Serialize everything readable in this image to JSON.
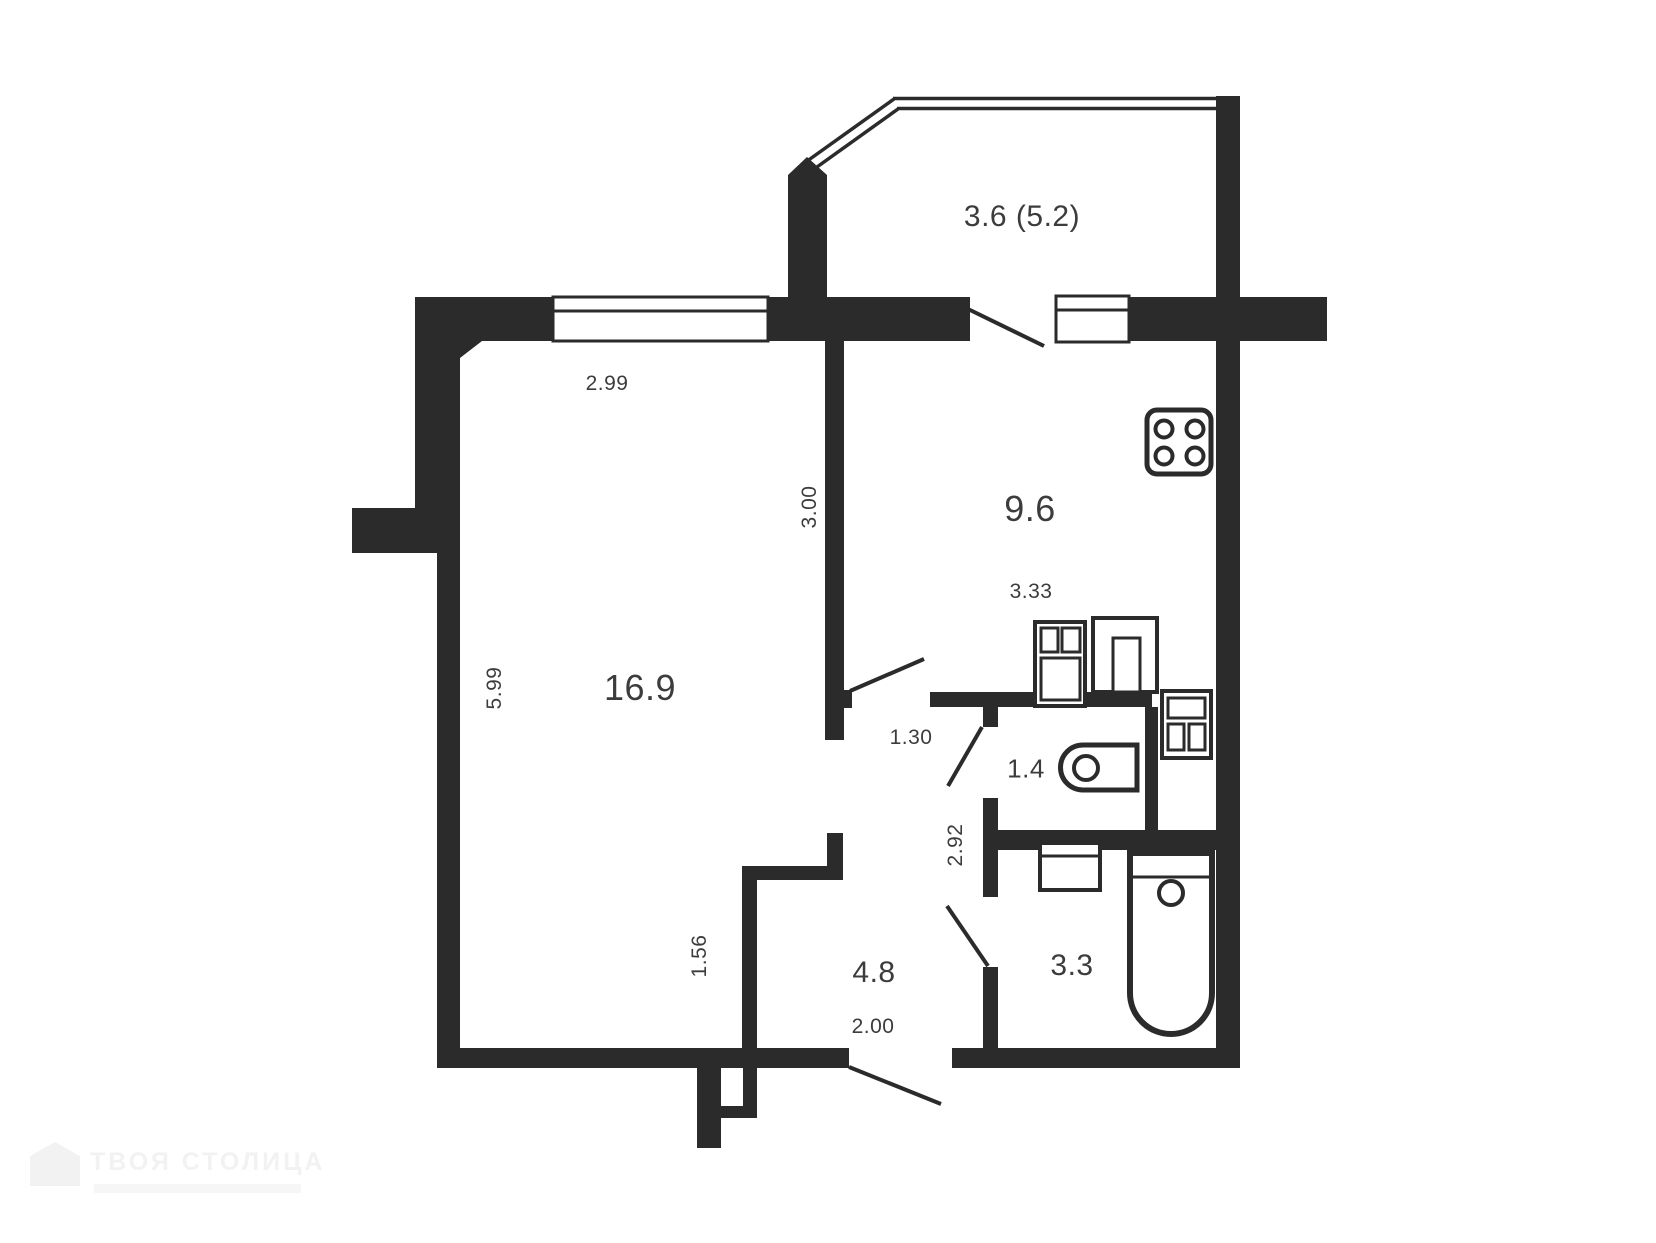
{
  "colors": {
    "wall": "#2b2b2b",
    "text": "#3c3c3c",
    "background": "#ffffff",
    "watermark": "#f2f2f2"
  },
  "rooms": {
    "balcony": {
      "name": "balcony",
      "area": "3.6 (5.2)"
    },
    "kitchen": {
      "name": "kitchen",
      "area": "9.6"
    },
    "living_room": {
      "name": "living-room",
      "area": "16.9"
    },
    "hallway": {
      "name": "hallway",
      "area": "4.8"
    },
    "toilet": {
      "name": "toilet",
      "area": "1.4"
    },
    "bathroom": {
      "name": "bathroom",
      "area": "3.3"
    }
  },
  "dimensions": {
    "living_width": "2.99",
    "kitchen_width": "3.00",
    "kitchen_depth": "3.33",
    "living_height": "5.99",
    "hall_door_width": "1.30",
    "hall_depth": "2.92",
    "living_nook": "1.56",
    "hall_width": "2.00"
  },
  "fixtures": [
    "stove-icon",
    "kitchen-sink-icon",
    "kitchen-cabinet-icon",
    "washer-icon",
    "toilet-icon",
    "bathroom-sink-icon",
    "bathtub-icon"
  ],
  "watermark": {
    "text": "ТВОЯ СТОЛИЦА"
  }
}
